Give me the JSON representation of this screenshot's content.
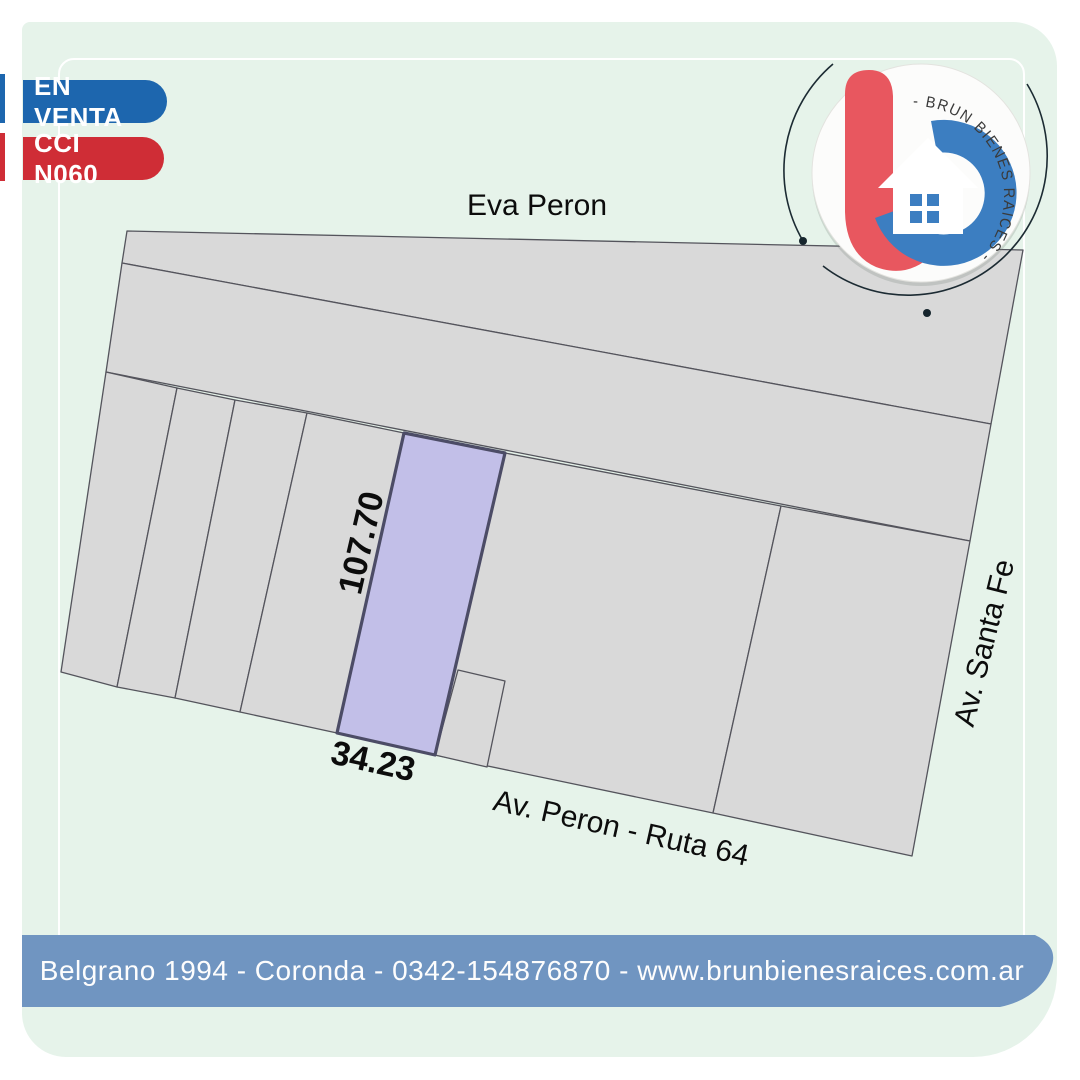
{
  "badges": {
    "status": "EN VENTA",
    "code": "CCI N060"
  },
  "map": {
    "street_top": "Eva Peron",
    "street_bottom": "Av. Peron - Ruta 64",
    "street_right": "Av. Santa Fe",
    "lot_depth": "107.70",
    "lot_front": "34.23"
  },
  "logo": {
    "brand_arc_text": "- BRUN BIENES RAICES -"
  },
  "footer": {
    "contact_line": "Belgrano 1994 - Coronda - 0342-154876870 - www.brunbienesraices.com.ar"
  },
  "colors": {
    "card_background": "#e6f3ea",
    "badge_status": "#1d66ae",
    "badge_code": "#cf2d36",
    "parcel_fill": "#d9d9d9",
    "parcel_stroke": "#54545c",
    "highlighted_lot_fill": "#c2bfe8",
    "highlighted_lot_stroke": "#4c4c66",
    "footer_bar": "#7095c1",
    "logo_red": "#e8575f",
    "logo_blue": "#3c7ec1"
  }
}
